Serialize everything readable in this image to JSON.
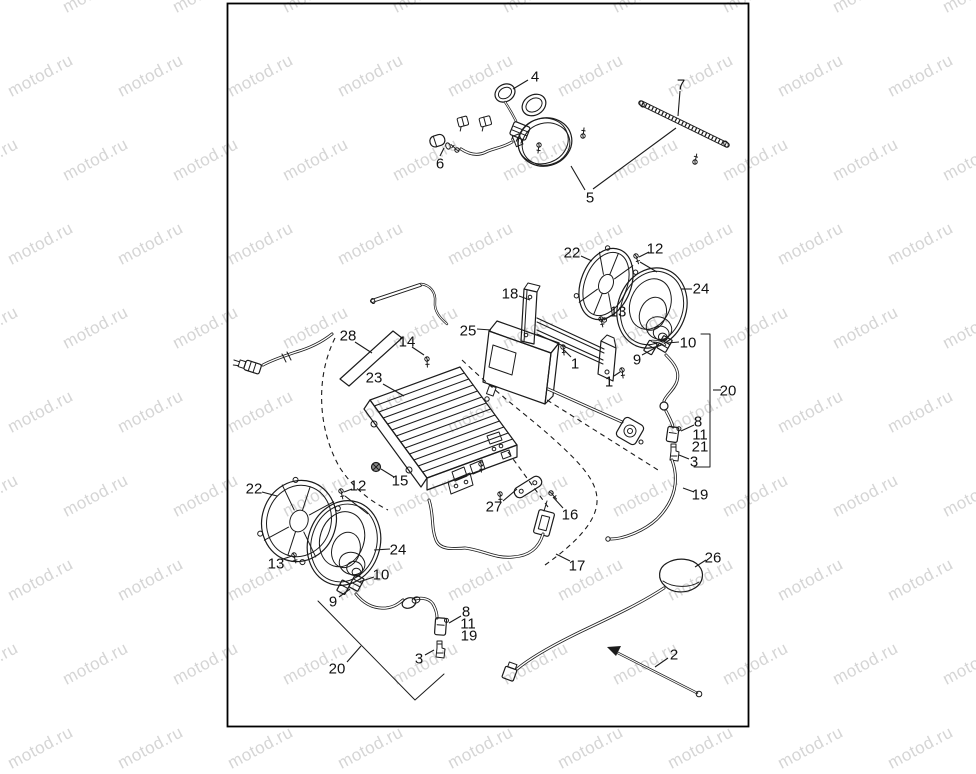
{
  "page": {
    "width": 976,
    "height": 732,
    "background": "#ffffff"
  },
  "watermark": {
    "text": "motod.ru",
    "color": "#d5d5d5",
    "font_size": 17,
    "rotation_deg": -28,
    "col_step": 110,
    "row_step": 84,
    "row_stagger": 55,
    "cols": 10,
    "rows": 10
  },
  "frame": {
    "x": 227.5,
    "y": 3.5,
    "width": 521,
    "height": 723,
    "stroke": "#000000",
    "stroke_width": 1.8
  },
  "diagram": {
    "ink": "#1b1b1b",
    "label_color": "#111111",
    "callouts": [
      {
        "label": "4",
        "x": 535,
        "y": 76
      },
      {
        "label": "6",
        "x": 440,
        "y": 163
      },
      {
        "label": "5",
        "x": 590,
        "y": 197
      },
      {
        "label": "7",
        "x": 681,
        "y": 84
      },
      {
        "label": "22",
        "x": 572,
        "y": 252
      },
      {
        "label": "12",
        "x": 655,
        "y": 248
      },
      {
        "label": "24",
        "x": 701,
        "y": 288
      },
      {
        "label": "13",
        "x": 618,
        "y": 311
      },
      {
        "label": "18",
        "x": 510,
        "y": 293
      },
      {
        "label": "25",
        "x": 468,
        "y": 330
      },
      {
        "label": "1",
        "x": 575,
        "y": 363
      },
      {
        "label": "1",
        "x": 609,
        "y": 381
      },
      {
        "label": "9",
        "x": 637,
        "y": 359
      },
      {
        "label": "10",
        "x": 688,
        "y": 342
      },
      {
        "label": "20",
        "x": 728,
        "y": 390
      },
      {
        "label": "8",
        "x": 698,
        "y": 421
      },
      {
        "label": "11",
        "x": 700,
        "y": 434
      },
      {
        "label": "21",
        "x": 700,
        "y": 446
      },
      {
        "label": "3",
        "x": 694,
        "y": 461
      },
      {
        "label": "19",
        "x": 700,
        "y": 494
      },
      {
        "label": "28",
        "x": 348,
        "y": 335
      },
      {
        "label": "14",
        "x": 407,
        "y": 341
      },
      {
        "label": "23",
        "x": 374,
        "y": 377
      },
      {
        "label": "15",
        "x": 400,
        "y": 480
      },
      {
        "label": "12",
        "x": 358,
        "y": 485
      },
      {
        "label": "22",
        "x": 254,
        "y": 488
      },
      {
        "label": "13",
        "x": 276,
        "y": 563
      },
      {
        "label": "24",
        "x": 398,
        "y": 549
      },
      {
        "label": "10",
        "x": 381,
        "y": 574
      },
      {
        "label": "9",
        "x": 333,
        "y": 601
      },
      {
        "label": "8",
        "x": 466,
        "y": 611
      },
      {
        "label": "11",
        "x": 468,
        "y": 623
      },
      {
        "label": "19",
        "x": 469,
        "y": 635
      },
      {
        "label": "3",
        "x": 419,
        "y": 658
      },
      {
        "label": "20",
        "x": 337,
        "y": 668
      },
      {
        "label": "27",
        "x": 494,
        "y": 506
      },
      {
        "label": "16",
        "x": 570,
        "y": 514
      },
      {
        "label": "17",
        "x": 577,
        "y": 565
      },
      {
        "label": "26",
        "x": 713,
        "y": 557
      },
      {
        "label": "2",
        "x": 674,
        "y": 654
      }
    ],
    "leaders": [
      [
        528,
        80,
        513,
        89
      ],
      [
        440,
        156,
        444,
        148
      ],
      [
        585,
        190,
        571,
        166
      ],
      [
        593,
        189,
        676,
        128
      ],
      [
        680,
        91,
        678,
        116
      ],
      [
        581,
        256,
        592,
        261
      ],
      [
        649,
        252,
        639,
        257
      ],
      [
        640,
        262,
        657,
        272
      ],
      [
        692,
        289,
        681,
        289
      ],
      [
        612,
        315,
        604,
        320
      ],
      [
        519,
        296,
        530,
        300
      ],
      [
        477,
        329,
        491,
        330
      ],
      [
        571,
        357,
        564,
        350
      ],
      [
        614,
        376,
        620,
        372
      ],
      [
        642,
        355,
        655,
        348
      ],
      [
        679,
        342,
        667,
        343
      ],
      [
        713,
        390,
        721,
        390
      ],
      [
        694,
        425,
        681,
        431
      ],
      [
        689,
        459,
        679,
        455
      ],
      [
        694,
        492,
        683,
        488
      ],
      [
        355,
        342,
        372,
        353
      ],
      [
        412,
        347,
        424,
        355
      ],
      [
        383,
        384,
        404,
        396
      ],
      [
        394,
        477,
        381,
        469
      ],
      [
        352,
        489,
        344,
        492
      ],
      [
        345,
        496,
        368,
        514
      ],
      [
        262,
        492,
        277,
        496
      ],
      [
        283,
        559,
        292,
        556
      ],
      [
        390,
        549,
        374,
        550
      ],
      [
        374,
        577,
        359,
        582
      ],
      [
        339,
        597,
        350,
        589
      ],
      [
        461,
        616,
        449,
        623
      ],
      [
        425,
        655,
        434,
        650
      ],
      [
        347,
        662,
        361,
        646
      ],
      [
        503,
        501,
        517,
        489
      ],
      [
        563,
        508,
        553,
        497
      ],
      [
        570,
        561,
        556,
        554
      ],
      [
        706,
        560,
        695,
        567
      ],
      [
        668,
        658,
        655,
        667
      ]
    ]
  }
}
